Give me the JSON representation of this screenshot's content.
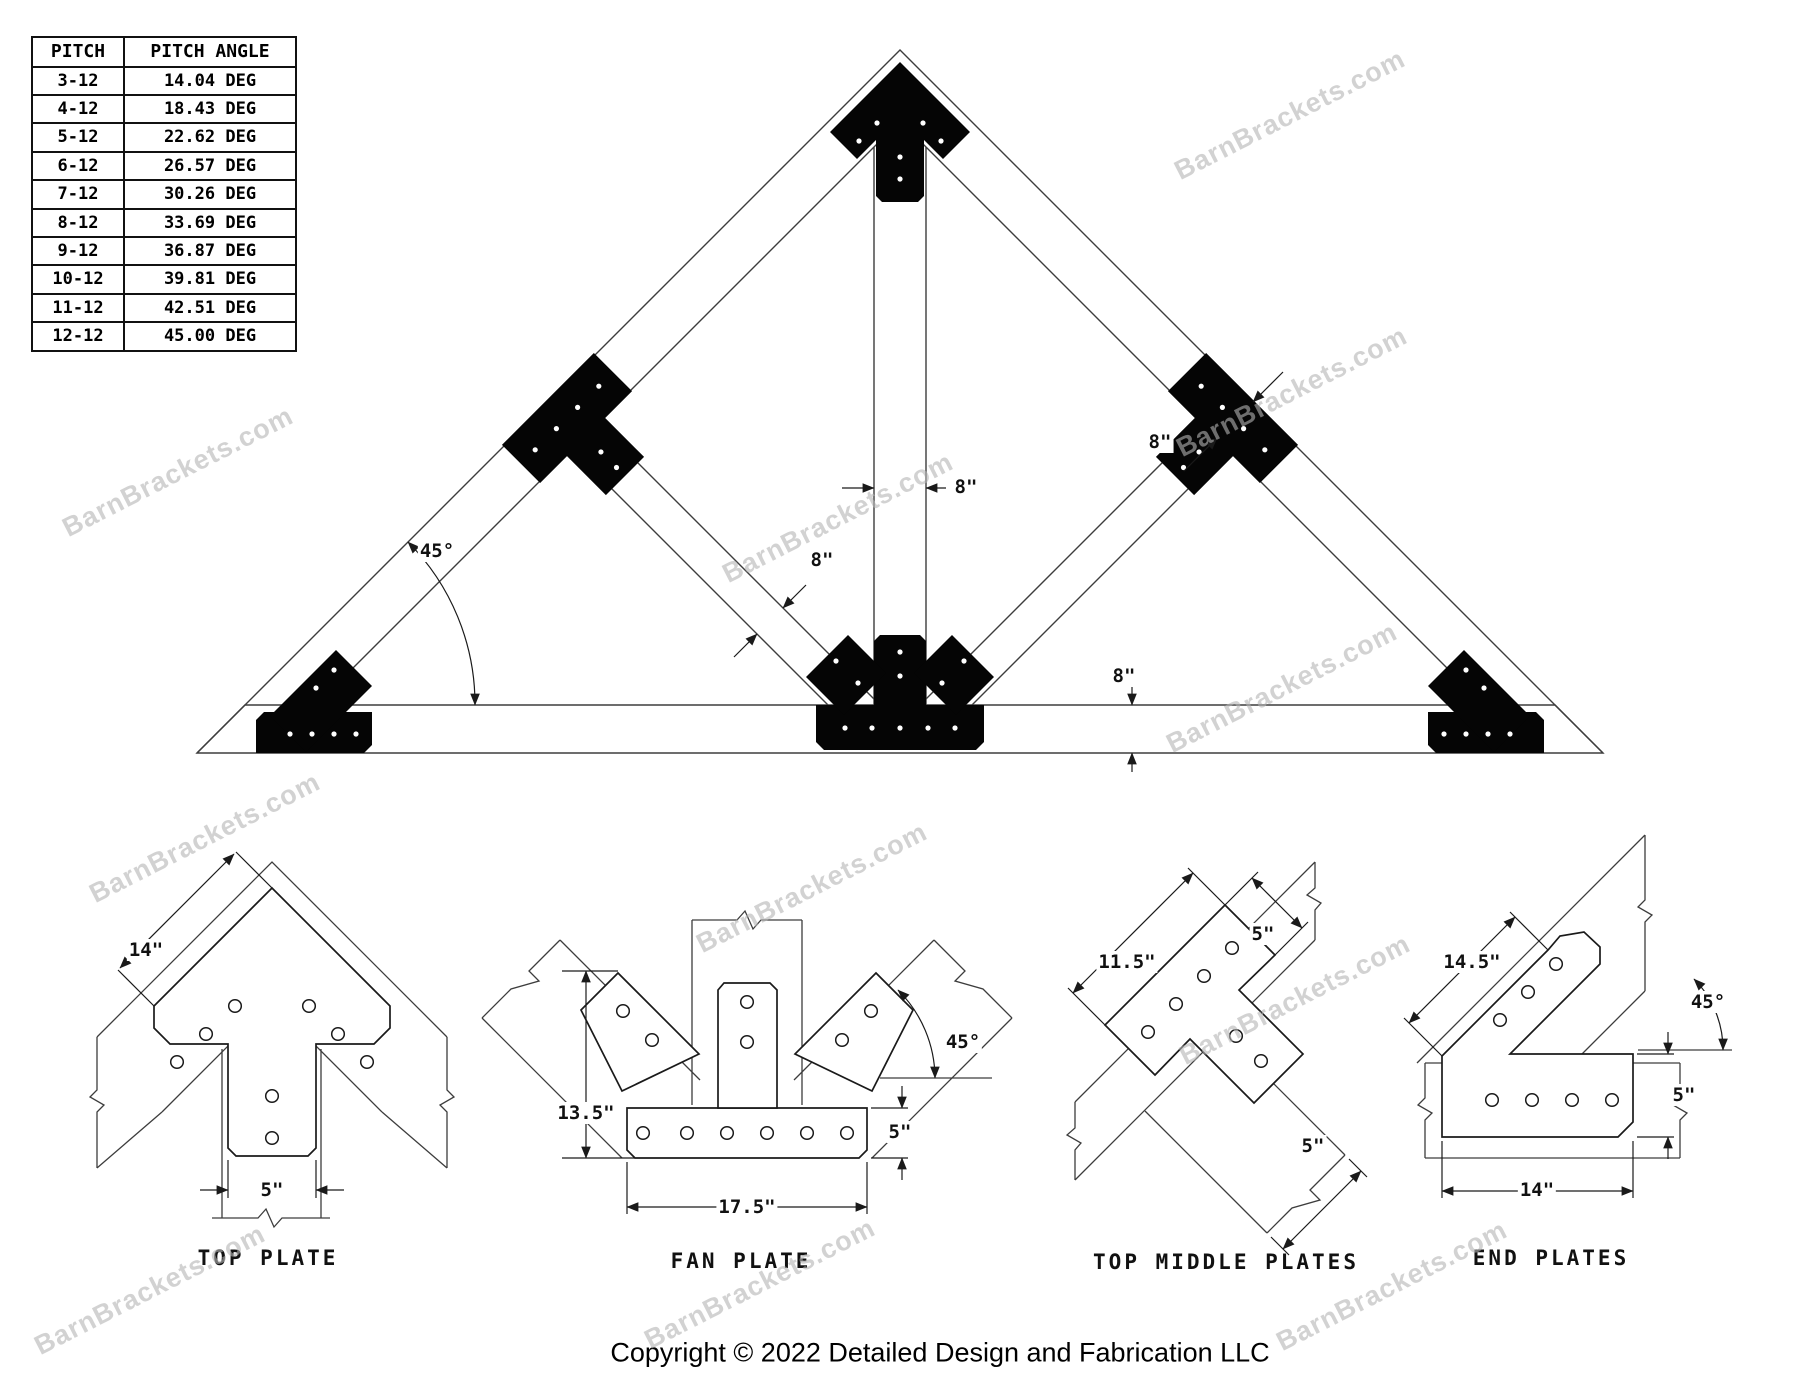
{
  "watermark": {
    "text": "BarnBrackets.com"
  },
  "pitch_table": {
    "headers": [
      "PITCH",
      "PITCH ANGLE"
    ],
    "rows": [
      [
        "3-12",
        "14.04 DEG"
      ],
      [
        "4-12",
        "18.43 DEG"
      ],
      [
        "5-12",
        "22.62 DEG"
      ],
      [
        "6-12",
        "26.57 DEG"
      ],
      [
        "7-12",
        "30.26 DEG"
      ],
      [
        "8-12",
        "33.69 DEG"
      ],
      [
        "9-12",
        "36.87 DEG"
      ],
      [
        "10-12",
        "39.81 DEG"
      ],
      [
        "11-12",
        "42.51 DEG"
      ],
      [
        "12-12",
        "45.00 DEG"
      ]
    ]
  },
  "truss": {
    "dims": {
      "king_post_width": "8\"",
      "web_width": "8\"",
      "rafter_depth": "8\"",
      "chord_depth": "8\"",
      "pitch_angle": "45°"
    }
  },
  "details": {
    "top_plate": {
      "label": "TOP PLATE",
      "dim_edge": "14\"",
      "dim_slot": "5\""
    },
    "fan_plate": {
      "label": "FAN PLATE",
      "dim_height": "13.5\"",
      "dim_base": "17.5\"",
      "dim_base_height": "5\"",
      "dim_angle": "45°"
    },
    "top_middle_plates": {
      "label": "TOP MIDDLE PLATES",
      "dim_length": "11.5\"",
      "dim_width_upper": "5\"",
      "dim_width_lower": "5\""
    },
    "end_plates": {
      "label": "END PLATES",
      "dim_edge": "14.5\"",
      "dim_angle": "45°",
      "dim_height": "5\"",
      "dim_base": "14\""
    }
  },
  "footer": {
    "copyright": "Copyright © 2022 Detailed Design and Fabrication LLC"
  }
}
